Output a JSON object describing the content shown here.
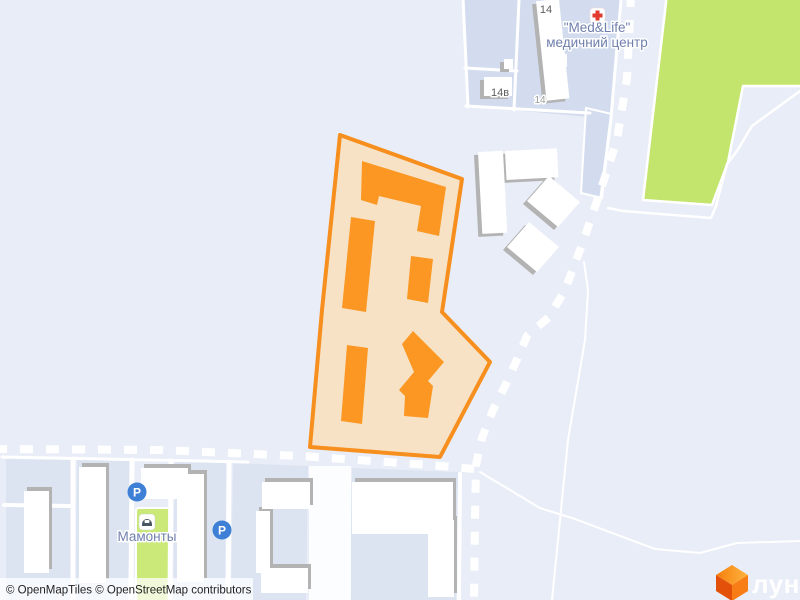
{
  "map": {
    "attribution": "© OpenMapTiles © OpenStreetMap contributors",
    "brand": {
      "logo_text": "лун",
      "logo_icon": "lun-cube-logo"
    },
    "poi": {
      "medlife": {
        "name": "\"Med&Life\"",
        "type": "медичний центр",
        "icon": "red-cross-icon"
      },
      "mamonty": {
        "name": "Мамонты",
        "icon": "storefront-icon"
      },
      "parking_label": "P"
    },
    "housenumbers": {
      "h14": "14",
      "h14v": "14в",
      "h14_on_building": "14"
    },
    "icons": [
      "red-cross-icon",
      "storefront-icon",
      "parking-icon",
      "lun-cube-logo"
    ],
    "colors": {
      "background": "#e9edf7",
      "parcel": "#dce4f2",
      "parcel_top": "#d3dcee",
      "road": "#ffffff",
      "green": "#c3e56d",
      "green_strip": "#cbe979",
      "site_fill": "#f7e2c6",
      "site_outline": "#f78f1e",
      "building_orange": "#fb9722",
      "building_white": "#ffffff",
      "building_shadow": "#b3b3b3",
      "parking_blue": "#3d80d6",
      "medical_red": "#e23a2e",
      "label_blue": "#6f7fad"
    }
  }
}
